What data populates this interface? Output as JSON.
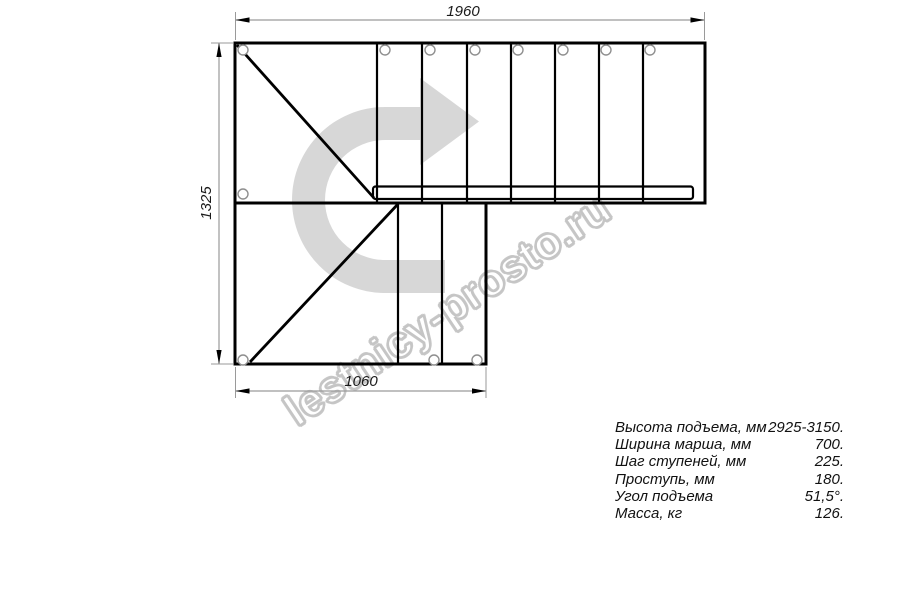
{
  "watermark": {
    "text": "lestnicy-prosto.ru",
    "arrow_icon": "u-turn-right-arrow-icon"
  },
  "drawing": {
    "type": "staircase-plan-top-view",
    "dimensions": {
      "top_width_mm": "1960",
      "left_height_mm": "1325",
      "bottom_width_mm": "1060"
    }
  },
  "specs": {
    "rows": [
      {
        "label": "Высота подъема, мм",
        "value": "2925-3150."
      },
      {
        "label": "Ширина марша, мм",
        "value": "700."
      },
      {
        "label": "Шаг ступеней, мм",
        "value": "225."
      },
      {
        "label": "Проступь, мм",
        "value": "180."
      },
      {
        "label": "Угол подъема",
        "value": "51,5°."
      },
      {
        "label": "Масса, кг",
        "value": "126."
      }
    ]
  },
  "colors": {
    "drawing_line": "#000000",
    "dimension_line": "#9a9a9a",
    "dimension_text": "#1a1a1a",
    "watermark_arrow": "#d7d7d7",
    "watermark_outline": "#c5c5c5",
    "hole_outline": "#8f8f8f",
    "background": "#ffffff"
  }
}
